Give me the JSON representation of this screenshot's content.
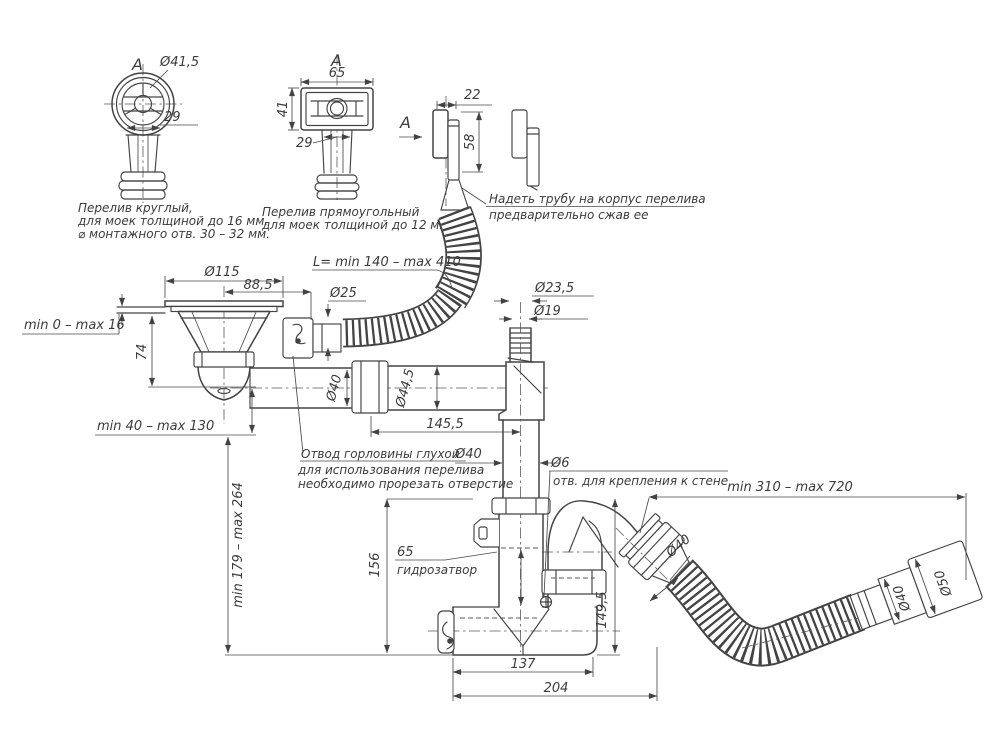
{
  "drawing": {
    "background": "#ffffff",
    "ink": "#434343"
  },
  "details": {
    "round_overflow": {
      "view_label": "А",
      "dia": "Ø41,5",
      "neck_width": "29",
      "caption_l1": "Перелив круглый,",
      "caption_l2": "для моек толщиной до 16 мм.",
      "caption_l3": "⌀ монтажного отв. 30 – 32 мм."
    },
    "rect_overflow": {
      "view_label": "А",
      "width": "65",
      "height": "41",
      "neck_width": "29",
      "caption_l1": "Перелив прямоугольный",
      "caption_l2": "для моек толщиной до 12 мм ."
    },
    "overflow_head": {
      "view_label": "А",
      "width": "22",
      "height": "58",
      "note_l1": "Надеть трубу на корпус перелива",
      "note_l2": "предварительно сжав ее"
    }
  },
  "main_view": {
    "flange_dia": "Ø115",
    "spout_offset": "88,5",
    "sink_thickness_range": "min 0 – max 16",
    "strainer_height": "74",
    "hose_length": "L= min 140 – max 410",
    "hose_dia": "Ø25",
    "port_dia_outer": "Ø23,5",
    "port_dia_inner": "Ø19",
    "tube_dia": "Ø40",
    "tube_dia_outer": "Ø44,5",
    "tube_length": "145,5",
    "height_adjust_range": "min 40 – max 130",
    "spout_note_l1": "Отвод горловины глухой",
    "spout_note_l2": "для использования перелива",
    "spout_note_l3": "необходимо прорезать отверстие",
    "drop_pipe_dia": "Ø40",
    "drop_height_range": "min 179 – max 264",
    "trap_depth": "156",
    "wall_hole_dia": "Ø6",
    "wall_hole_note": "отв. для крепления к стене",
    "outlet_reach_range": "min 310 – max 720",
    "water_seal_height": "65",
    "water_seal_label": "гидрозатвор",
    "outlet_dia": "Ø40",
    "outlet_drop": "149,5",
    "trap_width": "137",
    "trap_total_width": "204",
    "end_fitting_dia_small": "Ø40",
    "end_fitting_dia_large": "Ø50"
  }
}
